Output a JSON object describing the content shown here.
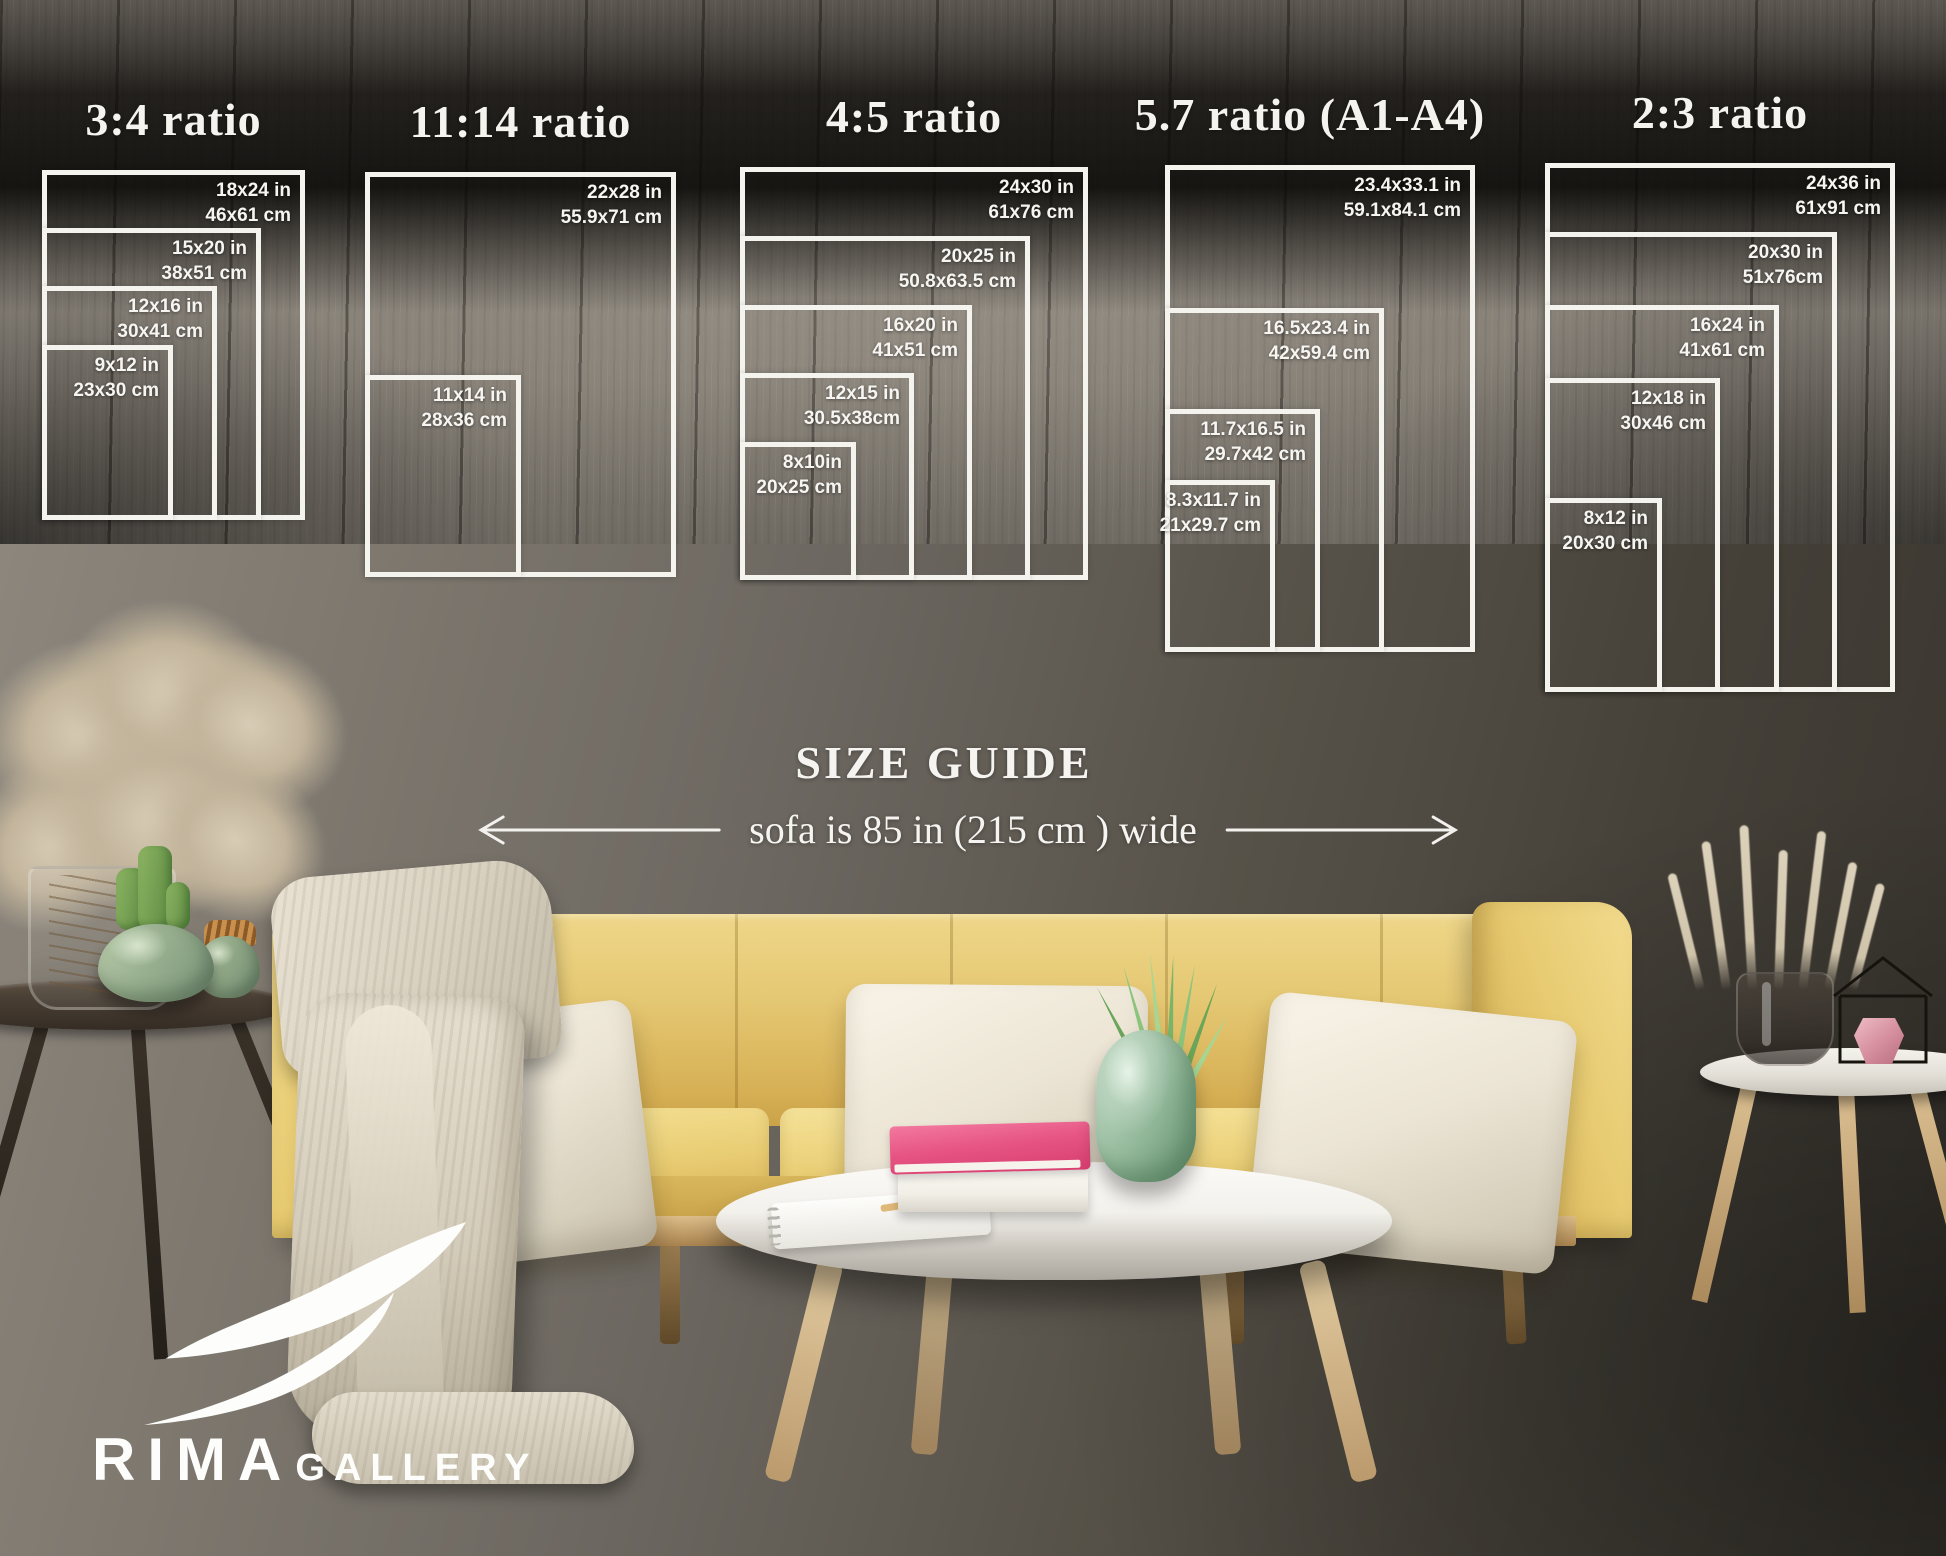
{
  "page": {
    "width": 1946,
    "height": 1556
  },
  "headings": {
    "size_guide": "SIZE GUIDE",
    "sofa_width_note": "sofa is 85 in (215 cm ) wide"
  },
  "brand": {
    "primary": "RIMA",
    "secondary": "GALLERY"
  },
  "ratio_groups": [
    {
      "title": "3:4 ratio",
      "sizes": [
        {
          "inches": "18x24 in",
          "cm": "46x61 cm",
          "w_in": 18,
          "h_in": 24
        },
        {
          "inches": "15x20 in",
          "cm": "38x51 cm",
          "w_in": 15,
          "h_in": 20
        },
        {
          "inches": "12x16 in",
          "cm": "30x41 cm",
          "w_in": 12,
          "h_in": 16
        },
        {
          "inches": "9x12 in",
          "cm": "23x30 cm",
          "w_in": 9,
          "h_in": 12
        }
      ]
    },
    {
      "title": "11:14 ratio",
      "sizes": [
        {
          "inches": "22x28 in",
          "cm": "55.9x71 cm",
          "w_in": 22,
          "h_in": 28
        },
        {
          "inches": "11x14 in",
          "cm": "28x36 cm",
          "w_in": 11,
          "h_in": 14
        }
      ]
    },
    {
      "title": "4:5 ratio",
      "sizes": [
        {
          "inches": "24x30 in",
          "cm": "61x76 cm",
          "w_in": 24,
          "h_in": 30
        },
        {
          "inches": "20x25 in",
          "cm": "50.8x63.5 cm",
          "w_in": 20,
          "h_in": 25
        },
        {
          "inches": "16x20 in",
          "cm": "41x51 cm",
          "w_in": 16,
          "h_in": 20
        },
        {
          "inches": "12x15 in",
          "cm": "30.5x38cm",
          "w_in": 12,
          "h_in": 15
        },
        {
          "inches": "8x10in",
          "cm": "20x25 cm",
          "w_in": 8,
          "h_in": 10
        }
      ]
    },
    {
      "title": "5.7 ratio (A1-A4)",
      "sizes": [
        {
          "inches": "23.4x33.1 in",
          "cm": "59.1x84.1 cm",
          "w_in": 23.4,
          "h_in": 33.1
        },
        {
          "inches": "16.5x23.4 in",
          "cm": "42x59.4 cm",
          "w_in": 16.5,
          "h_in": 23.4
        },
        {
          "inches": "11.7x16.5 in",
          "cm": "29.7x42 cm",
          "w_in": 11.7,
          "h_in": 16.5
        },
        {
          "inches": "8.3x11.7 in",
          "cm": "21x29.7 cm",
          "w_in": 8.3,
          "h_in": 11.7
        }
      ]
    },
    {
      "title": "2:3 ratio",
      "sizes": [
        {
          "inches": "24x36 in",
          "cm": "61x91 cm",
          "w_in": 24,
          "h_in": 36
        },
        {
          "inches": "20x30 in",
          "cm": "51x76cm",
          "w_in": 20,
          "h_in": 30
        },
        {
          "inches": "16x24 in",
          "cm": "41x61 cm",
          "w_in": 16,
          "h_in": 24
        },
        {
          "inches": "12x18 in",
          "cm": "30x46 cm",
          "w_in": 12,
          "h_in": 18
        },
        {
          "inches": "8x12 in",
          "cm": "20x30 cm",
          "w_in": 8,
          "h_in": 12
        }
      ]
    }
  ],
  "colors": {
    "diagram_line": "#f4f3ee",
    "wall_light": "#918b82",
    "wall_dark": "#37332d",
    "floor": "#857f76",
    "sofa_yellow": "#e5c873",
    "pillow_cream": "#ece5d5",
    "blanket_beige": "#d8d1c0",
    "book_pink": "#e75585",
    "vase_green": "#a9c9ae",
    "logo_white": "#fdfdfb"
  }
}
